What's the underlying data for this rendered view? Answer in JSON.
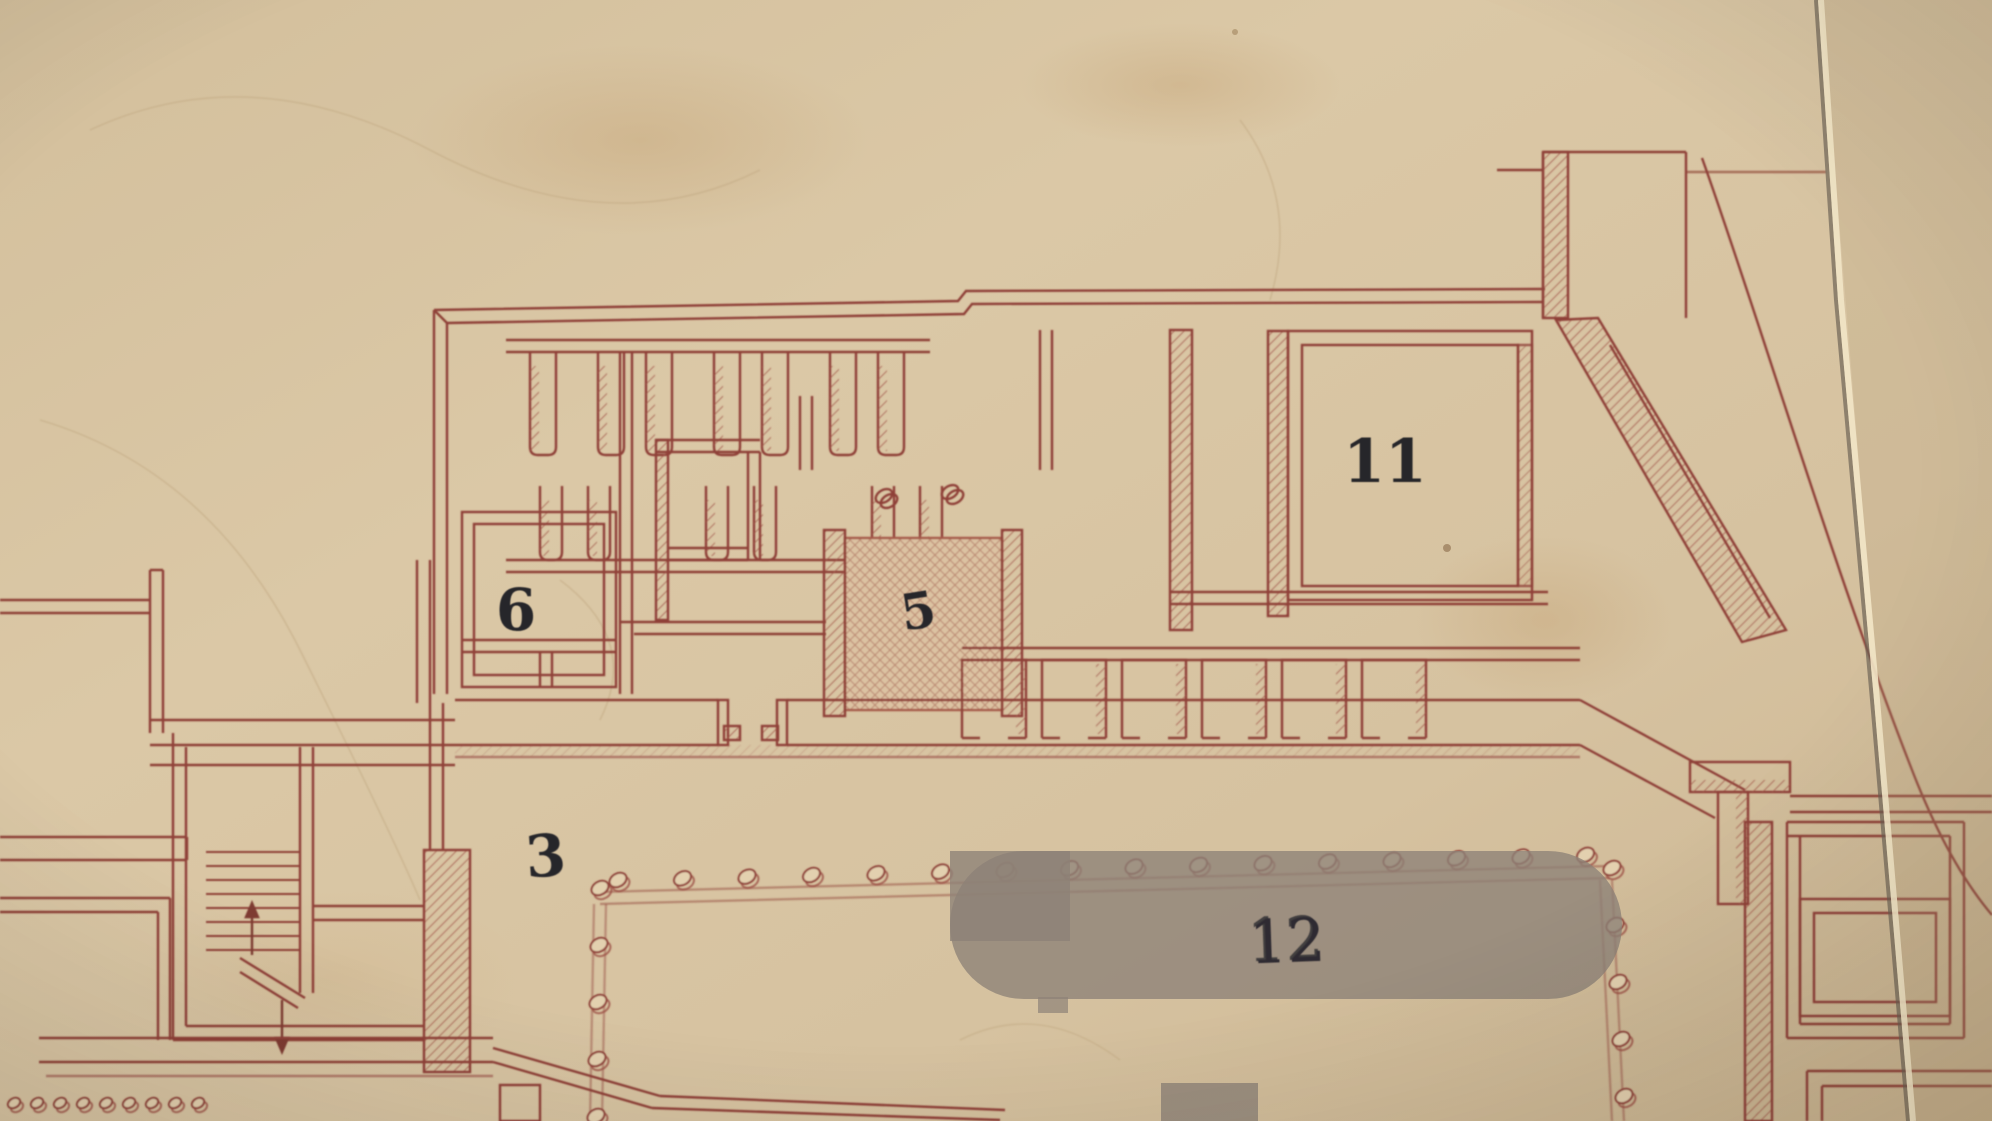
{
  "document": {
    "kind": "photographed archaeological floor plan, ink on toned paper",
    "visible_text_only": true
  },
  "labels": {
    "room6": "6",
    "room5": "5",
    "room11": "11",
    "area3": "3",
    "court12": "12"
  },
  "colors": {
    "paper": "#d7c3a1",
    "paper_light": "#e0cdab",
    "paper_dark": "#c7b08c",
    "ink": "#8f4038",
    "ink_light": "#b0685a",
    "crosshatch_fill": "#dcc2a2",
    "overlay_gray": "#8d8177",
    "crack_highlight": "#f2e5c6",
    "crack_shadow": "#675e51",
    "number_black": "#26262b"
  },
  "features": {
    "colonnade_top_count": 16,
    "colonnade_left_count": 5,
    "colonnade_right_count": 5,
    "colonnade_bottom_left_count": 9,
    "pilaster_row1_count": 7,
    "pilaster_row2_count": 6,
    "south_cell_count": 6,
    "stair_tread_count": 8,
    "stair_arrow_count": 2,
    "column_bases_room5": 2
  }
}
